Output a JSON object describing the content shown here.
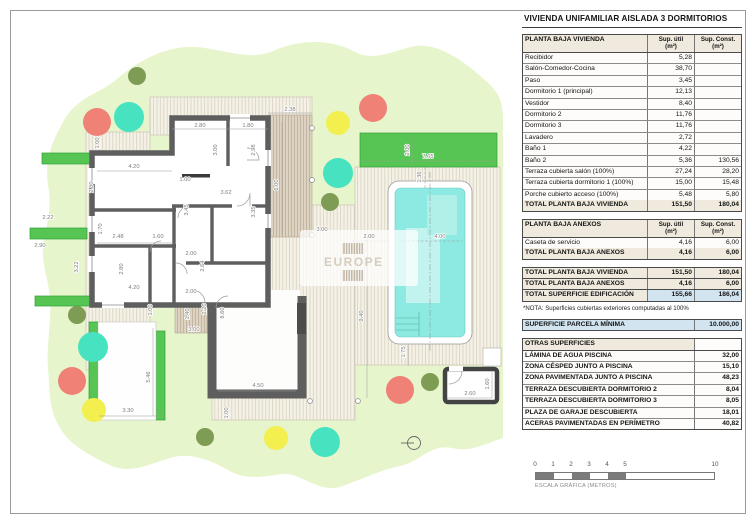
{
  "title": "VIVIENDA UNIFAMILIAR AISLADA 3 DORMITORIOS",
  "columns": {
    "util": "Sup. útil",
    "util_unit": "(m²)",
    "const": "Sup. Const.",
    "const_unit": "(m²)"
  },
  "vivienda": {
    "header": "PLANTA BAJA VIVIENDA",
    "rows": [
      [
        "Recibidor",
        "5,28",
        ""
      ],
      [
        "Salón-Comedor-Cocina",
        "38,70",
        ""
      ],
      [
        "Paso",
        "3,45",
        ""
      ],
      [
        "Dormitorio 1 (principal)",
        "12,13",
        ""
      ],
      [
        "Vestidor",
        "8,40",
        ""
      ],
      [
        "Dormitorio 2",
        "11,76",
        ""
      ],
      [
        "Dormitorio 3",
        "11,76",
        ""
      ],
      [
        "Lavadero",
        "2,72",
        ""
      ],
      [
        "Baño 1",
        "4,22",
        ""
      ],
      [
        "Baño 2",
        "5,36",
        "130,56"
      ],
      [
        "Terraza cubierta salón (100%)",
        "27,24",
        "28,20"
      ],
      [
        "Terraza cubierta dormitorio 1 (100%)",
        "15,00",
        "15,48"
      ],
      [
        "Porche cubierto acceso (100%)",
        "5,48",
        "5,80"
      ]
    ],
    "total": [
      "TOTAL PLANTA BAJA VIVIENDA",
      "151,50",
      "180,04"
    ]
  },
  "anexos": {
    "header": "PLANTA BAJA ANEXOS",
    "rows": [
      [
        "Caseta de servicio",
        "4,16",
        "6,00"
      ]
    ],
    "total": [
      "TOTAL PLANTA BAJA ANEXOS",
      "4,16",
      "6,00"
    ]
  },
  "totales": [
    [
      "TOTAL PLANTA BAJA VIVIENDA",
      "151,50",
      "180,04"
    ],
    [
      "TOTAL PLANTA BAJA ANEXOS",
      "4,16",
      "6,00"
    ],
    [
      "TOTAL SUPERFICIE EDIFICACIÓN",
      "155,66",
      "186,04"
    ]
  ],
  "nota": "*NOTA: Superficies cubiertas exteriores computadas al 100%",
  "parcela": [
    "SUPERFICIE PARCELA MÍNIMA",
    "10.000,00"
  ],
  "otras": {
    "header": "OTRAS SUPERFICIES",
    "rows": [
      [
        "LÁMINA DE AGUA PISCINA",
        "32,00"
      ],
      [
        "ZONA CÉSPED JUNTO A PISCINA",
        "15,10"
      ],
      [
        "ZONA PAVIMENTADA JUNTO A PISCINA",
        "48,23"
      ],
      [
        "TERRAZA DESCUBIERTA DORMITORIO 2",
        "8,04"
      ],
      [
        "TERRAZA DESCUBIERTA DORMITORIO 3",
        "8,05"
      ],
      [
        "PLAZA DE GARAJE DESCUBIERTA",
        "18,01"
      ],
      [
        "ACERAS PAVIMENTADAS EN PERÍMETRO",
        "40,82"
      ]
    ]
  },
  "scalebar": {
    "ticks": [
      {
        "t": "0",
        "m": 0
      },
      {
        "t": "1",
        "m": 1
      },
      {
        "t": "2",
        "m": 2
      },
      {
        "t": "3",
        "m": 3
      },
      {
        "t": "4",
        "m": 4
      },
      {
        "t": "5",
        "m": 5
      },
      {
        "t": "10",
        "m": 10
      }
    ],
    "caption": "ESCALA GRÁFICA (METROS)"
  },
  "plan": {
    "watermark": "EUROPE",
    "dims": [
      {
        "t": "2.80",
        "x": 200,
        "y": 127,
        "r": 0
      },
      {
        "t": "1.80",
        "x": 248,
        "y": 127,
        "r": 0
      },
      {
        "t": "3.00",
        "x": 217,
        "y": 150,
        "r": 90
      },
      {
        "t": "2.98",
        "x": 255,
        "y": 150,
        "r": 90
      },
      {
        "t": "2.38",
        "x": 290,
        "y": 111,
        "r": 0
      },
      {
        "t": "6.00",
        "x": 278,
        "y": 185,
        "r": 90
      },
      {
        "t": "1.00",
        "x": 99,
        "y": 143,
        "r": 90
      },
      {
        "t": "4.20",
        "x": 134,
        "y": 168,
        "r": 0
      },
      {
        "t": "2.80",
        "x": 93,
        "y": 187,
        "r": 90
      },
      {
        "t": "1.00",
        "x": 185,
        "y": 181,
        "r": 0
      },
      {
        "t": "3.62",
        "x": 226,
        "y": 194,
        "r": 0
      },
      {
        "t": "3.45",
        "x": 188,
        "y": 210,
        "r": 90
      },
      {
        "t": "3.35",
        "x": 255,
        "y": 212,
        "r": 90
      },
      {
        "t": "2.22",
        "x": 48,
        "y": 219,
        "r": 0
      },
      {
        "t": "1.70",
        "x": 102,
        "y": 229,
        "r": 90
      },
      {
        "t": "2.48",
        "x": 118,
        "y": 238,
        "r": 0
      },
      {
        "t": "1.60",
        "x": 158,
        "y": 238,
        "r": 0
      },
      {
        "t": "2.90",
        "x": 40,
        "y": 247,
        "r": 0
      },
      {
        "t": "3.22",
        "x": 78,
        "y": 267,
        "r": 90
      },
      {
        "t": "2.80",
        "x": 123,
        "y": 269,
        "r": 90
      },
      {
        "t": "4.20",
        "x": 134,
        "y": 289,
        "r": 0
      },
      {
        "t": "2.00",
        "x": 191,
        "y": 255,
        "r": 0
      },
      {
        "t": "2.64",
        "x": 204,
        "y": 266,
        "r": 90
      },
      {
        "t": "2.00",
        "x": 191,
        "y": 293,
        "r": 0
      },
      {
        "t": "2.20",
        "x": 206,
        "y": 309,
        "r": 90
      },
      {
        "t": "1.00",
        "x": 152,
        "y": 310,
        "r": 90
      },
      {
        "t": "1.40",
        "x": 189,
        "y": 314,
        "r": 90
      },
      {
        "t": "3.00",
        "x": 194,
        "y": 331,
        "r": 0
      },
      {
        "t": "8.60",
        "x": 224,
        "y": 313,
        "r": 90
      },
      {
        "t": "5.46",
        "x": 150,
        "y": 377,
        "r": 90
      },
      {
        "t": "3.30",
        "x": 128,
        "y": 412,
        "r": 0
      },
      {
        "t": "4.50",
        "x": 258,
        "y": 387,
        "r": 0
      },
      {
        "t": "1.00",
        "x": 228,
        "y": 413,
        "r": 90
      },
      {
        "t": "2.00",
        "x": 409,
        "y": 150,
        "r": 90
      },
      {
        "t": "7.65",
        "x": 428,
        "y": 158,
        "r": 0
      },
      {
        "t": "1.36",
        "x": 421,
        "y": 177,
        "r": 90
      },
      {
        "t": "2.00",
        "x": 369,
        "y": 238,
        "r": 0
      },
      {
        "t": "4.00",
        "x": 440,
        "y": 238,
        "r": 0
      },
      {
        "t": "3.00",
        "x": 322,
        "y": 231,
        "r": 0
      },
      {
        "t": "9.40",
        "x": 363,
        "y": 316,
        "r": 90
      },
      {
        "t": "1.75",
        "x": 405,
        "y": 352,
        "r": 90
      },
      {
        "t": "2.60",
        "x": 470,
        "y": 395,
        "r": 0
      },
      {
        "t": "1.60",
        "x": 489,
        "y": 384,
        "r": 90
      }
    ]
  }
}
